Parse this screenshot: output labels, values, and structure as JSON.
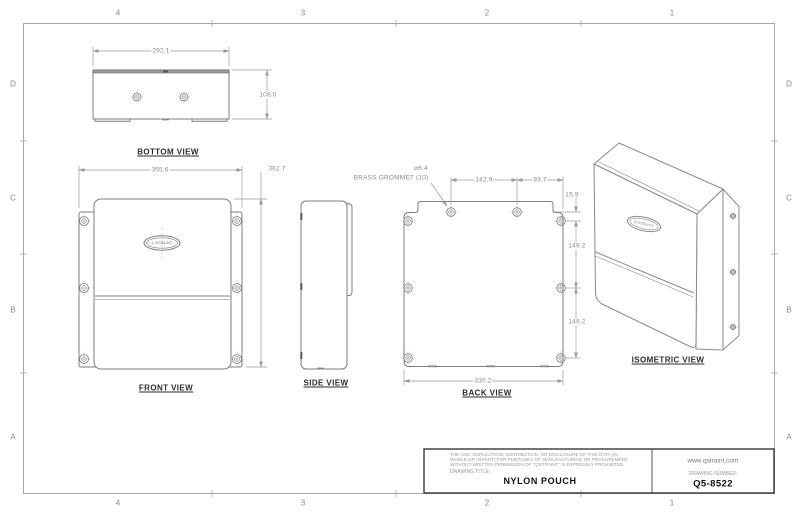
{
  "sheet": {
    "zone_columns": [
      "4",
      "3",
      "2",
      "1"
    ],
    "zone_rows": [
      "D",
      "C",
      "B",
      "A"
    ]
  },
  "logo": {
    "text": "Q'STRAINT"
  },
  "views": {
    "bottom_view": {
      "label": "BOTTOM VIEW",
      "width_dim": "292.1",
      "height_dim": "108.0"
    },
    "front_view": {
      "label": "FRONT VIEW",
      "width_dim": "355.6",
      "height_dim": "362.7"
    },
    "side_view": {
      "label": "SIDE VIEW"
    },
    "back_view": {
      "label": "BACK VIEW",
      "grommet_dia": "⌀6.4",
      "grommet_note": "BRASS GROMMET (10)",
      "dim_top_span": "142.9",
      "dim_top_right": "93.7",
      "dim_offset": "15.9",
      "dim_upper_spacing": "149.2",
      "dim_lower_spacing": "149.2",
      "dim_width": "330.2"
    },
    "isometric_view": {
      "label": "ISOMETRIC VIEW"
    }
  },
  "title_block": {
    "disclaimer": [
      "THE USE, DUPLICATION, DISTRIBUTION, OR DISCLOSURE OF THIS DATA (IN",
      "WHOLE OR IN PART) FOR PURPOSES OF MANUFACTURING OR PROCUREMENT",
      "WITHOUT WRITTEN PERMISSION OF \"Q'STRAINT\" IS EXPRESSLY PROHIBITED."
    ],
    "drawing_title_label": "DRAWING TITLE:",
    "drawing_title": "NYLON POUCH",
    "website": "www.qstraint.com",
    "drawing_number_label": "DRAWING NUMBER:",
    "drawing_number": "Q5-8522"
  }
}
